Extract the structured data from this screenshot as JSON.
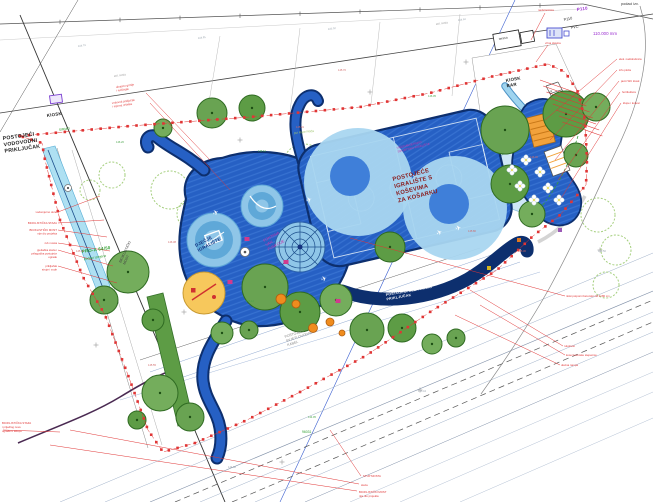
{
  "meta": {
    "kind": "landscape-site-plan",
    "bg": "#ffffff"
  },
  "palette": {
    "blue_main": "#2660c4",
    "blue_stripe": "#4a86e0",
    "navy": "#0d2f6e",
    "light_circle": "#a9d6f0",
    "mid_circle": "#3f7fd9",
    "tree_greens": [
      "#69a352",
      "#5d9c45",
      "#74ad5c"
    ],
    "tree_edge": "#2f6b22",
    "outline_tree": "#a5cf7e",
    "red": "#e03535",
    "cyan_path": "#aee0f2",
    "yellow": "#f7c85c"
  },
  "labels": [
    {
      "l": [
        "POSTOJEĆI",
        "VODOVODNI",
        "PRIKLJUČAK"
      ],
      "x": 3,
      "y": 140,
      "s": 5.2,
      "c": "#222",
      "r": -8,
      "w": 700,
      "lh": 6.4
    },
    {
      "l": [
        "KIOSK"
      ],
      "x": 47,
      "y": 117,
      "s": 4.4,
      "c": "#222",
      "r": -8,
      "w": 700
    },
    {
      "l": [
        "KIOSK",
        "BAR"
      ],
      "x": 506,
      "y": 82,
      "s": 4.4,
      "c": "#222",
      "r": -10,
      "w": 700,
      "lh": 5.4
    },
    {
      "l": [
        "terasa"
      ],
      "x": 499,
      "y": 40,
      "s": 3.2,
      "c": "#333",
      "r": -10
    },
    {
      "l": [
        "POSTOJEĆE",
        "IGRALIŠTE S",
        "KOŠEVIMA",
        "ZA KOŠARKU"
      ],
      "x": 393,
      "y": 181,
      "s": 5.8,
      "c": "#8a1a1a",
      "r": -14,
      "w": 700,
      "lh": 7.4
    },
    {
      "l": [
        "VIŠENAMJENSKO",
        "SPORTSKO IGRALIŠTE"
      ],
      "x": 397,
      "y": 149,
      "s": 3,
      "c": "#cc33aa",
      "r": -14,
      "lh": 3.8
    },
    {
      "l": [
        "POSTOJEĆI ELEKTRIČNI",
        "PRIKLJUČAK"
      ],
      "x": 386,
      "y": 296,
      "s": 3.5,
      "c": "#ffffff",
      "r": -10,
      "w": 700,
      "lh": 4.4
    },
    {
      "l": [
        "POSTOJEĆI",
        "SVJETLOVODNI",
        "KABEL"
      ],
      "x": 285,
      "y": 338,
      "s": 3.5,
      "c": "#8a8a8a",
      "r": -18,
      "lh": 4.3
    },
    {
      "l": [
        "FONTANA",
        "VAN",
        "FUNKCIJE"
      ],
      "x": 264,
      "y": 242,
      "s": 3.8,
      "c": "#cc33aa",
      "r": -28,
      "lh": 4.8
    },
    {
      "l": [
        "DJEČJE",
        "IGRALIŠTE"
      ],
      "x": 196,
      "y": 247,
      "s": 4.4,
      "c": "#16337f",
      "r": -28,
      "w": 700,
      "lh": 5.4
    },
    {
      "l": [
        "BICIKLISTIČKI",
        "MOST"
      ],
      "x": 121,
      "y": 263,
      "s": 3.5,
      "c": "#444",
      "r": -65,
      "lh": 4.4
    },
    {
      "l": [
        "P110"
      ],
      "x": 577,
      "y": 11,
      "s": 4.4,
      "c": "#9b30d0",
      "r": -8,
      "w": 700
    },
    {
      "l": [
        "P110"
      ],
      "x": 564,
      "y": 21,
      "s": 3.8,
      "c": "#333",
      "r": -12
    },
    {
      "l": [
        "PVC"
      ],
      "x": 571,
      "y": 29,
      "s": 3.8,
      "c": "#333",
      "r": -12
    },
    {
      "l": [
        "110.000 mm"
      ],
      "x": 593,
      "y": 35,
      "s": 4.4,
      "c": "#9b30d0"
    },
    {
      "l": [
        "podaci izv."
      ],
      "x": 621,
      "y": 5,
      "s": 3.8,
      "c": "#333"
    },
    {
      "l": [
        "PRO-A 64/50"
      ],
      "x": 82,
      "y": 253,
      "s": 4.4,
      "c": "#2e9e2e",
      "r": -8,
      "w": 700
    },
    {
      "l": [
        "podaci izmjene"
      ],
      "x": 84,
      "y": 260,
      "s": 3.4,
      "c": "#2e9e2e",
      "r": -8
    },
    {
      "l": [
        "SIRMO"
      ],
      "x": 59,
      "y": 131,
      "s": 3.4,
      "c": "#2e9e2e",
      "r": -8
    },
    {
      "l": [
        "96031"
      ],
      "x": 302,
      "y": 433,
      "s": 3.4,
      "c": "#2e9e2e"
    },
    {
      "l": [
        "put Mare Pitića"
      ],
      "x": 294,
      "y": 134,
      "s": 3,
      "c": "#9cc36a",
      "r": -6
    },
    {
      "l": [
        "asf. cesta"
      ],
      "x": 114,
      "y": 77,
      "s": 2.8,
      "c": "#999",
      "r": -8
    },
    {
      "l": [
        "asf. cesta"
      ],
      "x": 436,
      "y": 25,
      "s": 2.8,
      "c": "#999",
      "r": -8
    },
    {
      "l": [
        "elek. nadstrešnica"
      ],
      "x": 619,
      "y": 60,
      "s": 2.8,
      "c": "#e03535"
    },
    {
      "l": [
        "info ploča"
      ],
      "x": 619,
      "y": 71,
      "s": 2.8,
      "c": "#e03535"
    },
    {
      "l": [
        "javni WC kiosk"
      ],
      "x": 621,
      "y": 82,
      "s": 2.8,
      "c": "#e03535"
    },
    {
      "l": [
        "hortikultura"
      ],
      "x": 622,
      "y": 93,
      "s": 2.8,
      "c": "#e03535"
    },
    {
      "l": [
        "klupe i koševi"
      ],
      "x": 623,
      "y": 104,
      "s": 2.8,
      "c": "#e03535"
    },
    {
      "l": [
        "niski potporni betonski zid h=80 cm"
      ],
      "x": 566,
      "y": 297,
      "s": 2.8,
      "c": "#e03535"
    },
    {
      "l": [
        "rukohvat"
      ],
      "x": 564,
      "y": 347,
      "s": 2.8,
      "c": "#e03535"
    },
    {
      "l": [
        "kose betonske stepenice"
      ],
      "x": 566,
      "y": 356,
      "s": 2.8,
      "c": "#e03535"
    },
    {
      "l": [
        "ulazna rampa"
      ],
      "x": 561,
      "y": 366,
      "s": 2.8,
      "c": "#e03535"
    },
    {
      "l": [
        "STUP MOSTA"
      ],
      "x": 363,
      "y": 477,
      "s": 2.8,
      "c": "#e03535"
    },
    {
      "l": [
        "staza"
      ],
      "x": 361,
      "y": 486,
      "s": 2.8,
      "c": "#e03535"
    },
    {
      "l": [
        "BICIKLISTIČKI MOST",
        "nije dio projekta"
      ],
      "x": 359,
      "y": 493,
      "s": 2.8,
      "c": "#e03535",
      "lh": 3.8
    },
    {
      "l": [
        "BICIKLISTIČKA STAZA",
        "i prijedlog nove",
        "ograde u sklopu"
      ],
      "x": 2,
      "y": 424,
      "s": 2.8,
      "c": "#e03535",
      "lh": 4
    },
    {
      "l": [
        "vodomjerno okno"
      ],
      "x": 57,
      "y": 213,
      "s": 2.8,
      "c": "#e03535",
      "a": "end"
    },
    {
      "l": [
        "BICIKLISTIČKA STAZA"
      ],
      "x": 57,
      "y": 224,
      "s": 2.8,
      "c": "#e03535",
      "a": "end"
    },
    {
      "l": [
        "BICIKLISTIČKI MOST",
        "nije dio projekta"
      ],
      "x": 57,
      "y": 231,
      "s": 2.8,
      "c": "#e03535",
      "a": "end",
      "lh": 3.6
    },
    {
      "l": [
        "rub mosta"
      ],
      "x": 57,
      "y": 244,
      "s": 2.8,
      "c": "#e03535",
      "a": "end"
    },
    {
      "l": [
        "pješačka staza i",
        "prilagodba postojeće",
        "ograde"
      ],
      "x": 57,
      "y": 251,
      "s": 2.8,
      "c": "#e03535",
      "a": "end",
      "lh": 3.6
    },
    {
      "l": [
        "priključak",
        "struje i vode"
      ],
      "x": 57,
      "y": 267,
      "s": 2.8,
      "c": "#e03535",
      "a": "end",
      "lh": 3.6
    },
    {
      "l": [
        "ukrasno grmlje",
        "i ružičnjak"
      ],
      "x": 116,
      "y": 88,
      "s": 2.8,
      "c": "#e03535",
      "r": -8,
      "lh": 3.6
    },
    {
      "l": [
        "vodovod priključak",
        "i mjerna rešetka"
      ],
      "x": 112,
      "y": 104,
      "s": 2.8,
      "c": "#e03535",
      "r": -8,
      "lh": 3.6
    },
    {
      "l": [
        "nadstrešnica"
      ],
      "x": 538,
      "y": 11,
      "s": 2.8,
      "c": "#e03535"
    },
    {
      "l": [
        "vrtna slavina"
      ],
      "x": 545,
      "y": 44,
      "s": 2.8,
      "c": "#e03535"
    },
    {
      "l": [
        "2"
      ],
      "x": 549,
      "y": 92,
      "s": 3.8,
      "c": "#222",
      "r": 40
    }
  ],
  "numbers": [
    [
      "144.79",
      78,
      47,
      "g",
      -8
    ],
    [
      "144.81",
      198,
      39,
      "g",
      -8
    ],
    [
      "145.02",
      328,
      30,
      "g",
      -8
    ],
    [
      "144.63",
      458,
      21,
      "g",
      -8
    ],
    [
      "146.38",
      168,
      243,
      "r",
      0
    ],
    [
      "146.62",
      258,
      152,
      "e",
      0
    ],
    [
      "145.91",
      296,
      128,
      "r",
      0
    ],
    [
      "146.05",
      428,
      97,
      "e",
      0
    ],
    [
      "145.80",
      468,
      232,
      "r",
      0
    ],
    [
      "146.12",
      246,
      302,
      "e",
      0
    ],
    [
      "145.55",
      148,
      366,
      "r",
      0
    ],
    [
      "144.95",
      308,
      418,
      "e",
      0
    ],
    [
      "145.30",
      518,
      252,
      "r",
      0
    ],
    [
      "146.20",
      116,
      143,
      "e",
      0
    ],
    [
      "145.70",
      338,
      71,
      "r",
      0
    ],
    [
      "144.50",
      598,
      252,
      "g",
      0
    ],
    [
      "145.10",
      76,
      252,
      "r",
      0
    ],
    [
      "144.88",
      228,
      468,
      "g",
      0
    ],
    [
      "145.44",
      418,
      392,
      "g",
      0
    ],
    [
      "146.00",
      530,
      158,
      "r",
      0
    ]
  ],
  "number_colors": {
    "g": "#9aa4ae",
    "r": "#d06868",
    "e": "#4aa44a"
  },
  "trees": [
    [
      212,
      113,
      15
    ],
    [
      252,
      108,
      13
    ],
    [
      163,
      128,
      9
    ],
    [
      505,
      130,
      24
    ],
    [
      566,
      114,
      23
    ],
    [
      596,
      107,
      14
    ],
    [
      576,
      155,
      12
    ],
    [
      510,
      184,
      19
    ],
    [
      532,
      214,
      13
    ],
    [
      265,
      287,
      23
    ],
    [
      300,
      312,
      20
    ],
    [
      336,
      300,
      16
    ],
    [
      367,
      330,
      17
    ],
    [
      402,
      328,
      14
    ],
    [
      432,
      344,
      10
    ],
    [
      456,
      338,
      9
    ],
    [
      390,
      247,
      15
    ],
    [
      128,
      272,
      21
    ],
    [
      104,
      300,
      14
    ],
    [
      153,
      320,
      11
    ],
    [
      160,
      393,
      18
    ],
    [
      190,
      417,
      14
    ],
    [
      137,
      420,
      9
    ],
    [
      222,
      333,
      11
    ],
    [
      249,
      330,
      9
    ]
  ],
  "outline_trees": [
    [
      170,
      190,
      19
    ],
    [
      214,
      181,
      21
    ],
    [
      259,
      172,
      19
    ],
    [
      304,
      165,
      21
    ],
    [
      349,
      158,
      19
    ],
    [
      394,
      150,
      21
    ],
    [
      438,
      143,
      19
    ],
    [
      478,
      136,
      17
    ],
    [
      192,
      214,
      15
    ],
    [
      240,
      205,
      17
    ],
    [
      290,
      197,
      15
    ],
    [
      339,
      190,
      17
    ],
    [
      388,
      182,
      15
    ],
    [
      433,
      175,
      13
    ],
    [
      598,
      215,
      17
    ],
    [
      616,
      250,
      15
    ],
    [
      606,
      285,
      13
    ],
    [
      112,
      175,
      13
    ],
    [
      90,
      190,
      10
    ]
  ],
  "boundary": {
    "points": [
      [
        20,
        136
      ],
      [
        130,
        126
      ],
      [
        250,
        117
      ],
      [
        360,
        107
      ],
      [
        430,
        93
      ],
      [
        494,
        76
      ],
      [
        548,
        64
      ],
      [
        565,
        72
      ],
      [
        578,
        92
      ],
      [
        585,
        120
      ],
      [
        587,
        160
      ],
      [
        586,
        185
      ],
      [
        560,
        215
      ],
      [
        533,
        236
      ],
      [
        497,
        270
      ],
      [
        430,
        312
      ],
      [
        367,
        355
      ],
      [
        300,
        392
      ],
      [
        247,
        420
      ],
      [
        195,
        443
      ],
      [
        163,
        452
      ],
      [
        148,
        430
      ],
      [
        128,
        375
      ],
      [
        105,
        315
      ],
      [
        83,
        277
      ],
      [
        60,
        220
      ],
      [
        45,
        160
      ],
      [
        42,
        143
      ],
      [
        20,
        136
      ]
    ],
    "square_step": 9,
    "square_size": 2.6
  },
  "leaders": [
    [
      210,
      160,
      146,
      93
    ],
    [
      230,
      190,
      150,
      103
    ],
    [
      350,
      238,
      565,
      296
    ],
    [
      470,
      290,
      563,
      346
    ],
    [
      480,
      305,
      565,
      355
    ],
    [
      455,
      315,
      560,
      365
    ],
    [
      330,
      430,
      361,
      476
    ],
    [
      70,
      430,
      359,
      484
    ],
    [
      50,
      445,
      357,
      491
    ],
    [
      545,
      120,
      617,
      59
    ],
    [
      550,
      140,
      617,
      70
    ],
    [
      555,
      160,
      619,
      81
    ],
    [
      558,
      180,
      620,
      92
    ],
    [
      560,
      200,
      621,
      103
    ],
    [
      58,
      212,
      100,
      196
    ],
    [
      58,
      223,
      104,
      220
    ],
    [
      58,
      230,
      107,
      237
    ],
    [
      58,
      243,
      110,
      251
    ],
    [
      58,
      250,
      113,
      266
    ],
    [
      58,
      266,
      117,
      283
    ],
    [
      545,
      13,
      531,
      40
    ],
    [
      548,
      45,
      536,
      62
    ],
    [
      3,
      430,
      60,
      432
    ]
  ],
  "hatch": {
    "n": 8,
    "x": 540,
    "y": 80,
    "dx": 3.2,
    "dy": 6,
    "len_x": 40,
    "len_y": 14
  },
  "survey_lines": [
    [
      0,
      24,
      583,
      4,
      "#555",
      0.7,
      ""
    ],
    [
      583,
      4,
      653,
      19,
      "#555",
      0.7,
      ""
    ],
    [
      0,
      40,
      580,
      9,
      "#bbb",
      0.4,
      ""
    ],
    [
      0,
      113,
      653,
      14,
      "#444",
      0.8,
      ""
    ],
    [
      515,
      0,
      280,
      502,
      "#3a5fd0",
      0.6,
      ""
    ],
    [
      20,
      15,
      225,
      502,
      "#333",
      0.9,
      ""
    ],
    [
      0,
      132,
      78,
      0,
      "#555",
      0.5,
      ""
    ],
    [
      57,
      148,
      148,
      448,
      "#888",
      0.5,
      ""
    ],
    [
      72,
      150,
      162,
      445,
      "#999",
      0.4,
      ""
    ],
    [
      150,
      372,
      500,
      252,
      "#8fa8d0",
      0.5,
      ""
    ],
    [
      160,
      385,
      520,
      262,
      "#8fa8d0",
      0.5,
      ""
    ],
    [
      140,
      360,
      480,
      248,
      "#666",
      0.5,
      ""
    ],
    [
      120,
      400,
      540,
      272,
      "#8fa8d0",
      0.4,
      ""
    ],
    [
      220,
      36,
      206,
      120,
      "#aaa",
      0.4,
      ""
    ],
    [
      300,
      28,
      290,
      112,
      "#aaa",
      0.4,
      ""
    ],
    [
      380,
      22,
      371,
      104,
      "#aaa",
      0.4,
      ""
    ],
    [
      460,
      14,
      452,
      96,
      "#aaa",
      0.4,
      ""
    ]
  ],
  "road_lines": [
    [
      60,
      502,
      653,
      253,
      "#9fb0c8",
      0.5,
      ""
    ],
    [
      105,
      502,
      653,
      272,
      "#9fb0c8",
      0.5,
      ""
    ],
    [
      150,
      502,
      653,
      291,
      "#8090a8",
      0.6,
      ""
    ],
    [
      200,
      502,
      653,
      312,
      "#9fb0c8",
      0.5,
      ""
    ],
    [
      255,
      502,
      653,
      332,
      "#9fb0c8",
      0.5,
      ""
    ],
    [
      305,
      502,
      653,
      352,
      "#8090a8",
      0.5,
      ""
    ],
    [
      350,
      502,
      653,
      372,
      "#9fb0c8",
      0.4,
      ""
    ],
    [
      400,
      502,
      653,
      392,
      "#9fb0c8",
      0.4,
      ""
    ],
    [
      460,
      502,
      653,
      418,
      "#9fb0c8",
      0.4,
      ""
    ],
    [
      175,
      502,
      653,
      300,
      "#555",
      0.7,
      "6,4"
    ],
    [
      232,
      502,
      653,
      322,
      "#555",
      0.7,
      "6,4"
    ]
  ],
  "crosses": [
    [
      240,
      140
    ],
    [
      370,
      92
    ],
    [
      466,
      62
    ],
    [
      184,
      312
    ],
    [
      420,
      390
    ],
    [
      282,
      462
    ],
    [
      600,
      250
    ],
    [
      96,
      345
    ]
  ],
  "flowers": [
    [
      512,
      170
    ],
    [
      526,
      160
    ],
    [
      540,
      172
    ],
    [
      520,
      186
    ],
    [
      548,
      188
    ],
    [
      559,
      200
    ],
    [
      534,
      200
    ]
  ],
  "orange_dots": [
    [
      281,
      299,
      5
    ],
    [
      296,
      304,
      4
    ],
    [
      313,
      328,
      4.5
    ],
    [
      330,
      322,
      4
    ],
    [
      342,
      333,
      3
    ]
  ],
  "magenta_markers": [
    [
      247,
      239
    ],
    [
      286,
      262
    ],
    [
      338,
      301
    ],
    [
      230,
      282
    ]
  ],
  "micro_markers": [
    [
      519,
      240,
      "#e07820"
    ],
    [
      489,
      268,
      "#d4b51e"
    ],
    [
      560,
      230,
      "#9b59b6"
    ]
  ],
  "birds": [
    [
      307,
      203,
      -20
    ],
    [
      438,
      236,
      -30
    ],
    [
      456,
      231,
      -15
    ],
    [
      214,
      216,
      -25
    ],
    [
      322,
      282,
      -20
    ]
  ],
  "bird_glyph": "✈"
}
